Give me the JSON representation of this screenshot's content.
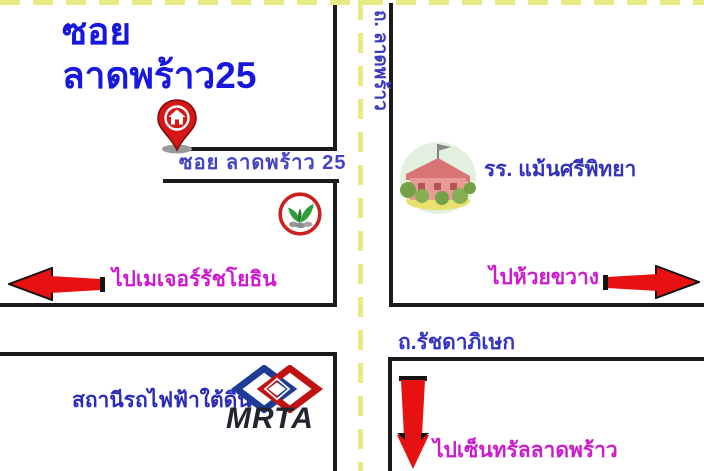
{
  "title": {
    "line1": "ซอย",
    "line2": "ลาดพร้าว25"
  },
  "labels": {
    "soi_road": "ซอย ลาดพร้าว 25",
    "ladprao_road_vertical": "ถ. ลาดพร้าว",
    "school": "รร. แม้นศรีพิทยา",
    "to_major_ratchayothin": "ไปเมเจอร์รัชโยธิน",
    "to_huai_khwang": "ไปห้วยขวาง",
    "ratchadaphisek_road": "ถ.รัชดาภิเษก",
    "subway_station": "สถานีรถไฟฟ้าใต้ดิน",
    "mrta_logo_text": "MRTA",
    "to_central_ladprao": "ไปเซ็นทรัลลาดพร้าว"
  },
  "icons": {
    "home_pin": "home-pin-icon",
    "kasikorn_bank": "kasikorn-bank-logo-icon",
    "school_building": "school-building-icon",
    "mrta_logo": "mrta-logo-icon",
    "arrow_left": "red-arrow-left-icon",
    "arrow_right": "red-arrow-right-icon",
    "arrow_down": "red-arrow-down-icon"
  },
  "colors": {
    "title_blue": "#1717dd",
    "road_label_blue": "#3838c0",
    "direction_magenta": "#cf19cf",
    "arrow_red": "#e81111",
    "road_line_black": "#1b1b1b",
    "lane_marking_yellow": "#e8ea84",
    "background": "#ffffff"
  }
}
